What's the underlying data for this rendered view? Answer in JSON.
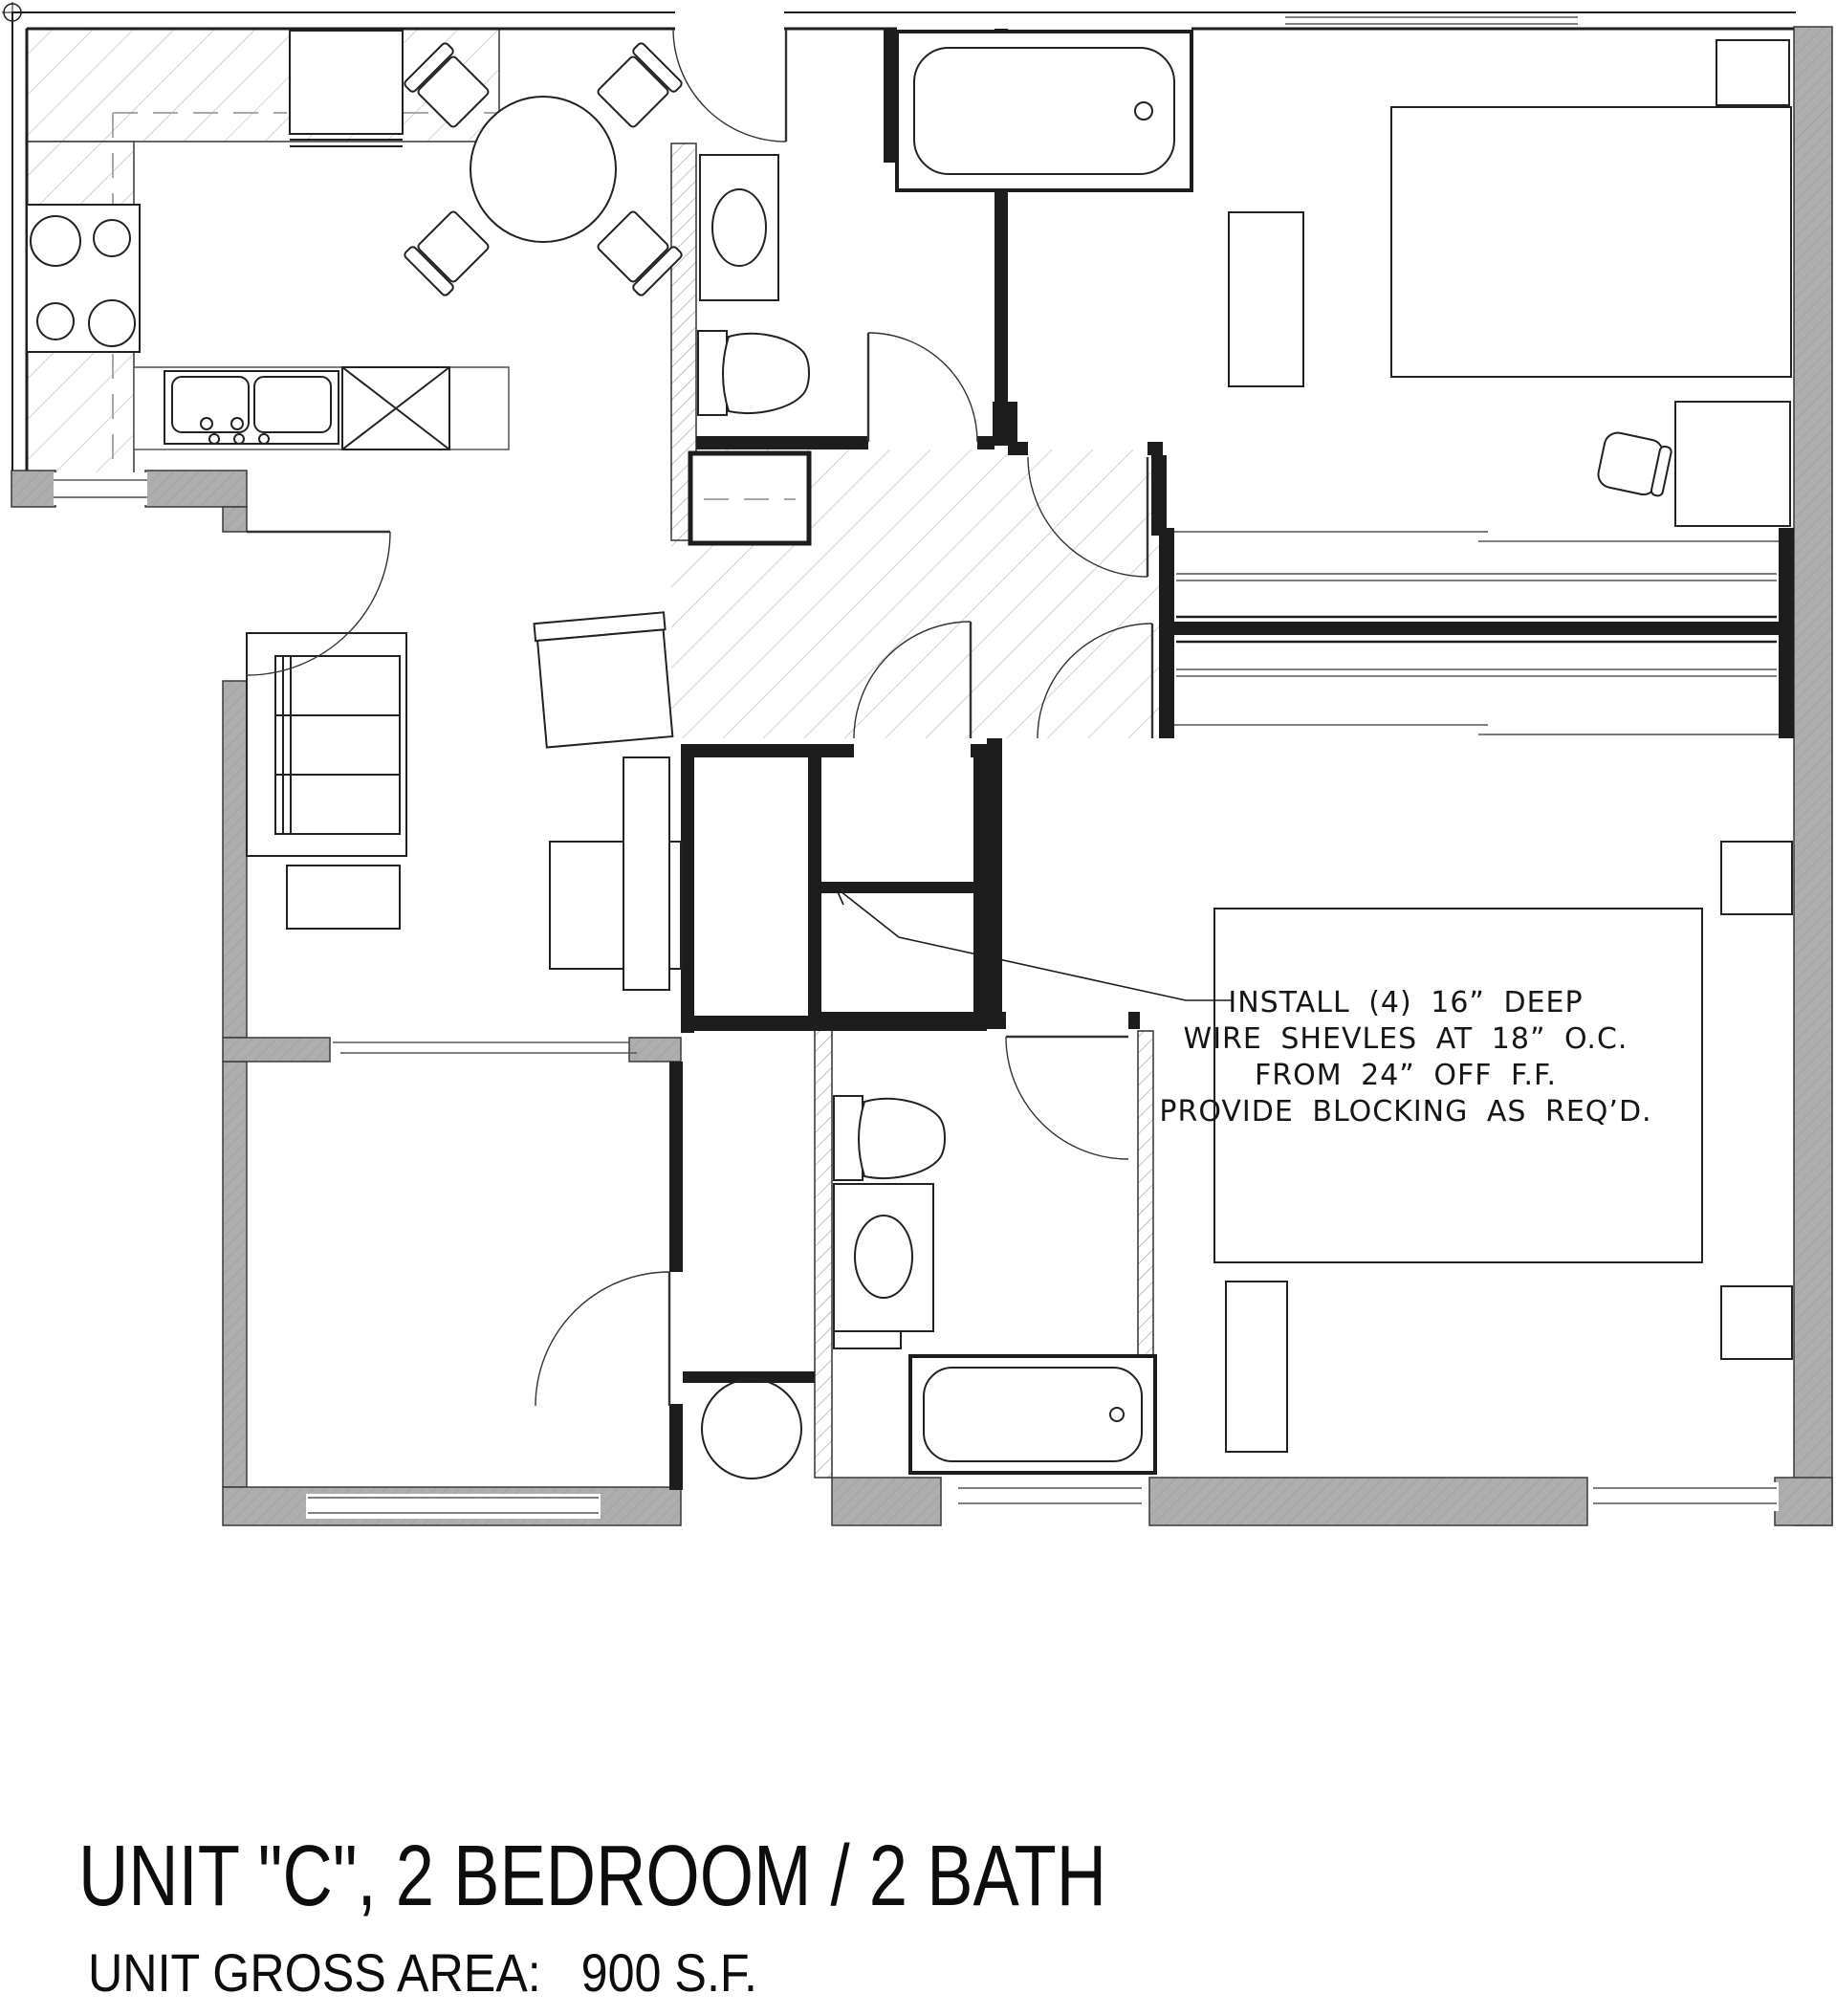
{
  "drawing": {
    "title": "UNIT \"C\", 2 BEDROOM / 2 BATH",
    "area_note": "UNIT GROSS AREA:   900 S.F.",
    "annotation": {
      "lines": [
        "INSTALL (4) 16” DEEP",
        "WIRE SHEVLES AT 18” O.C.",
        "FROM 24” OFF F.F.",
        "PROVIDE BLOCKING AS REQ’D."
      ]
    },
    "colors": {
      "wall_gray": "#aeaeae",
      "line": "#1d1d1d",
      "hatch_light": "#c8c8c8"
    }
  }
}
